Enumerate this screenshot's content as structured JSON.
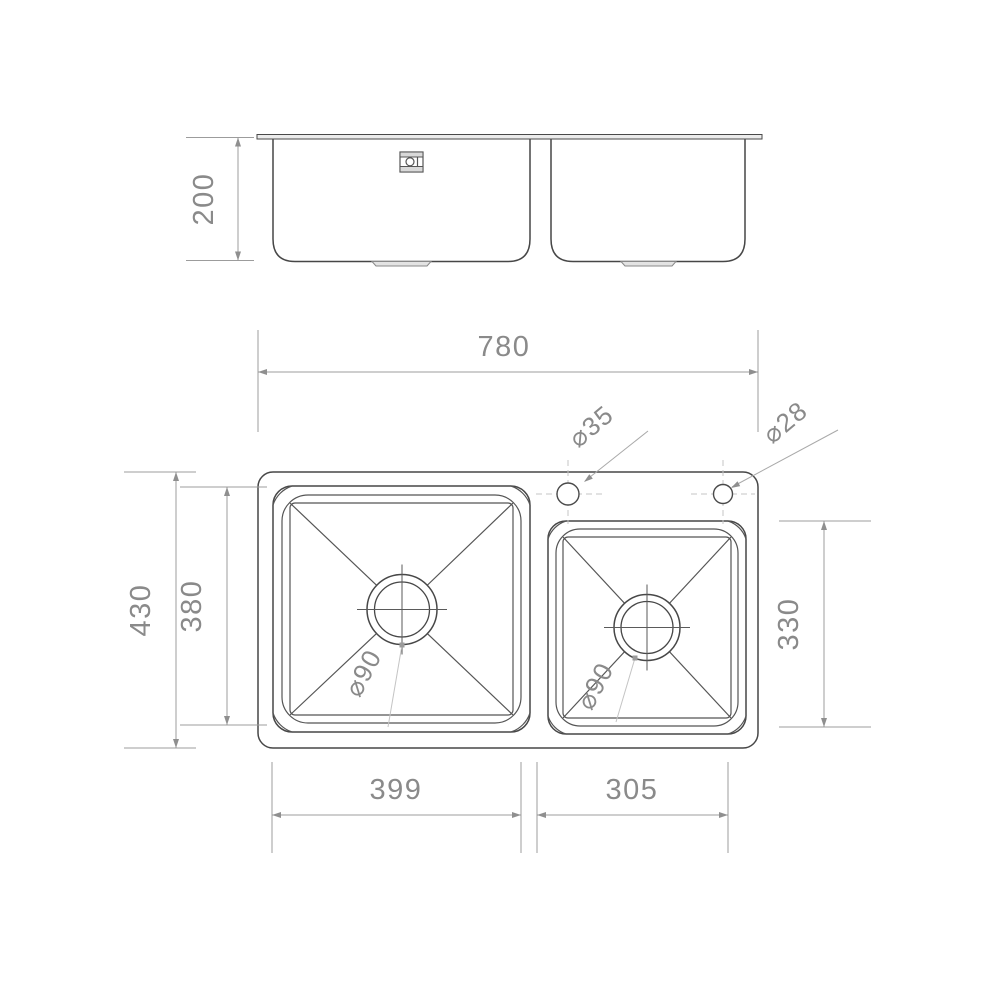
{
  "drawing": {
    "type": "technical-drawing",
    "subject": "double-bowl-kitchen-sink",
    "colors": {
      "outline": "#474747",
      "dimension_line": "#9c9c9c",
      "dimension_text": "#8a8a8a",
      "centerline": "#c6c6c6",
      "leader_line": "#c4c4c4",
      "background": "#ffffff"
    },
    "front_view": {
      "depth": {
        "label": "200"
      },
      "logo": "brand-emblem"
    },
    "plan_view": {
      "overall_width": {
        "label": "780"
      },
      "overall_depth": {
        "label": "430"
      },
      "left_bowl_depth": {
        "label": "380"
      },
      "right_bowl_depth": {
        "label": "330"
      },
      "left_bowl_width": {
        "label": "399"
      },
      "right_bowl_width": {
        "label": "305"
      },
      "faucet_hole_left": {
        "label": "⌀35"
      },
      "faucet_hole_right": {
        "label": "⌀28"
      },
      "left_drain": {
        "label": "⌀90"
      },
      "right_drain": {
        "label": "⌀90"
      }
    }
  }
}
